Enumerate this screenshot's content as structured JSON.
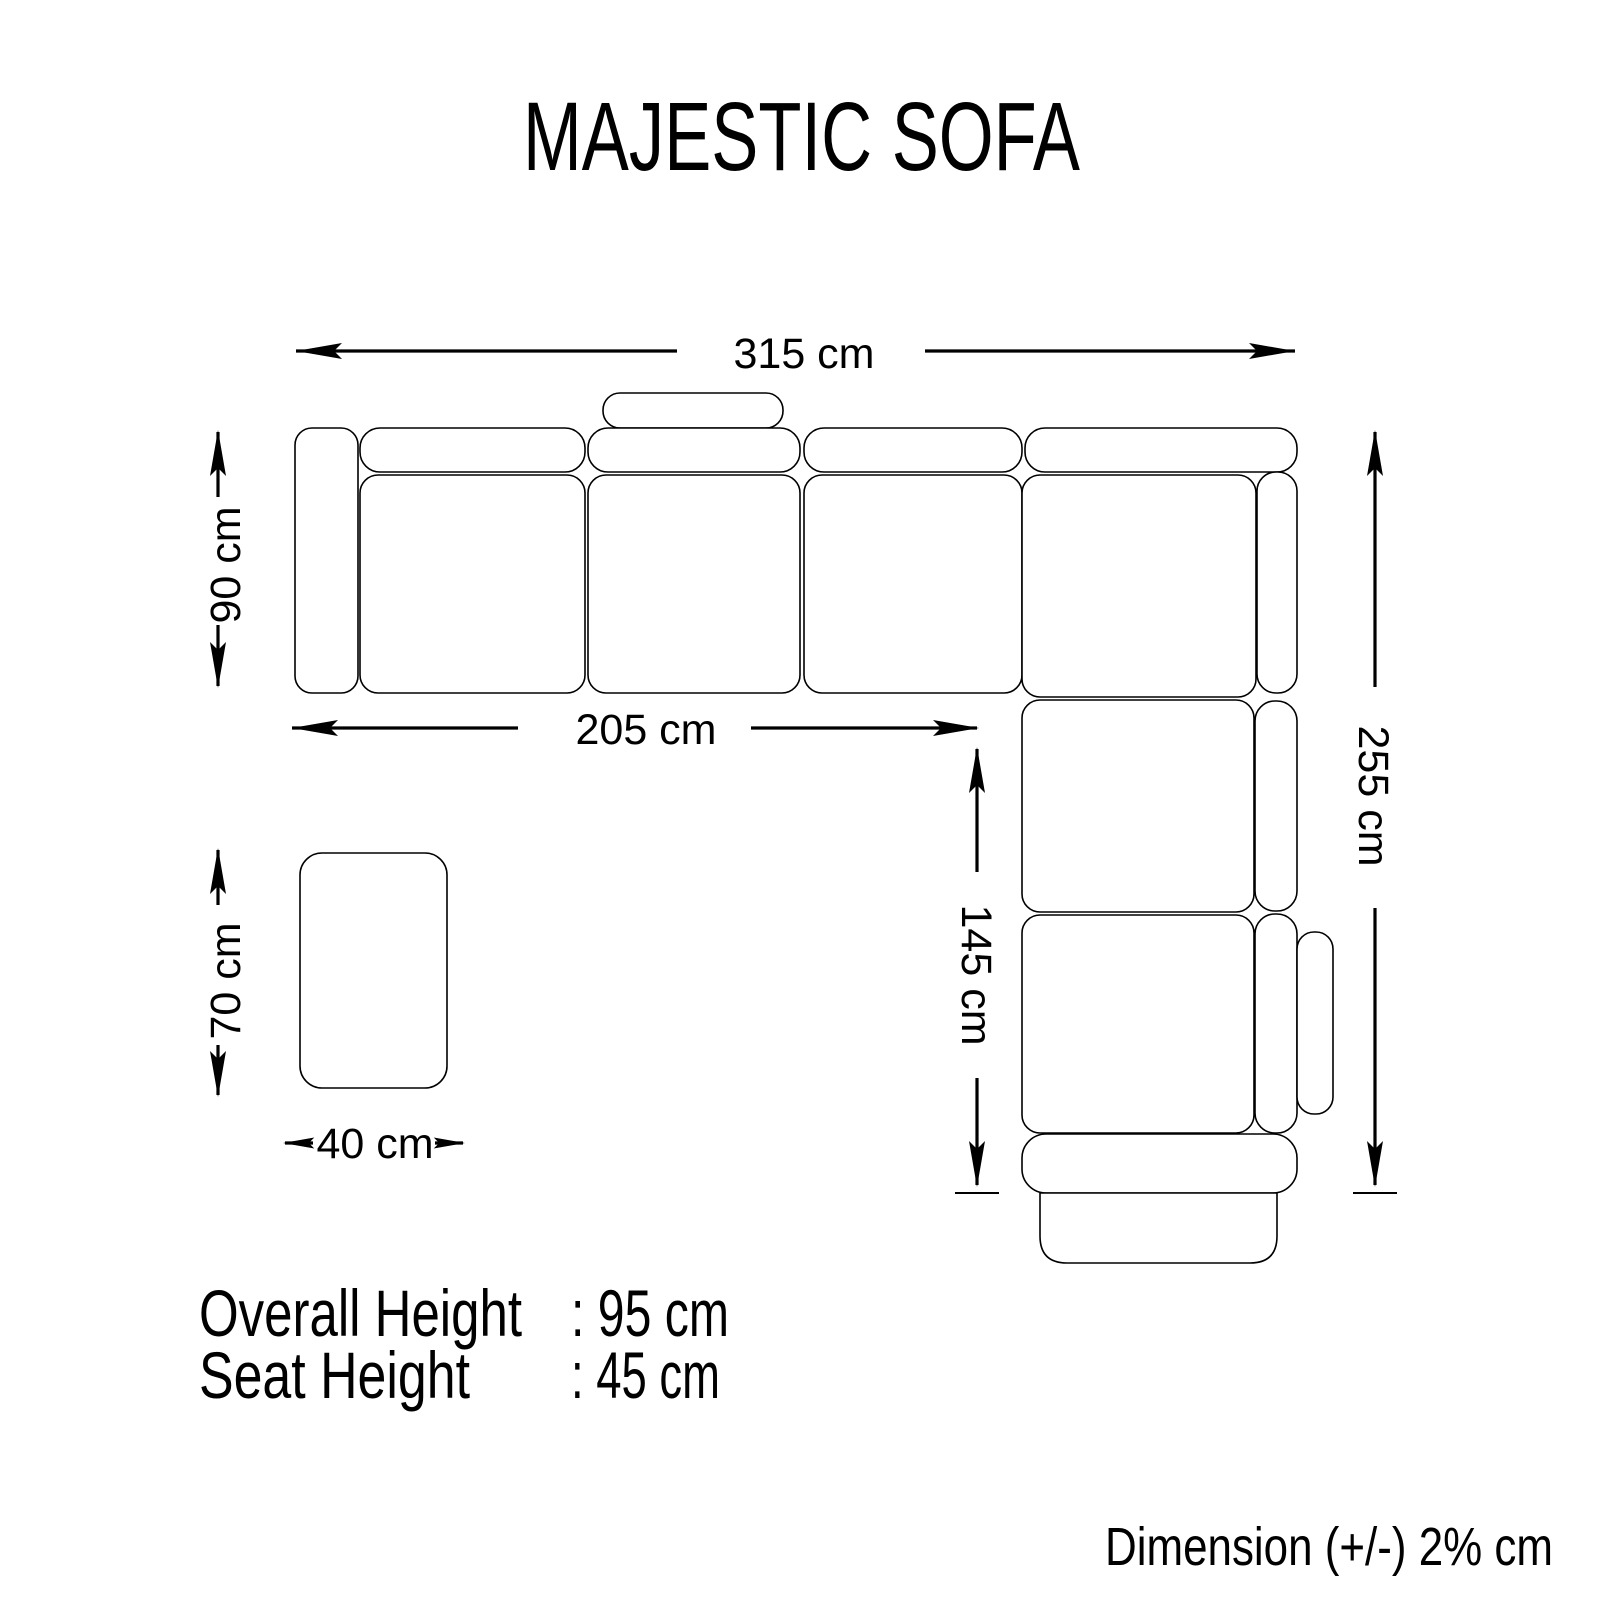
{
  "title": "MAJESTIC SOFA",
  "dims": {
    "total_width": "315 cm",
    "left_depth": "90 cm",
    "seat_run": "205 cm",
    "inner_depth": "145 cm",
    "right_depth": "255 cm",
    "ottoman_depth": "70 cm",
    "ottoman_width": "40 cm"
  },
  "specs": {
    "overall_height": {
      "label": "Overall Height",
      "value": ": 95 cm"
    },
    "seat_height": {
      "label": "Seat Height",
      "value": ": 45 cm"
    }
  },
  "tolerance_note": "Dimension (+/-) 2% cm",
  "colors": {
    "line": "#000000",
    "background": "#ffffff"
  }
}
